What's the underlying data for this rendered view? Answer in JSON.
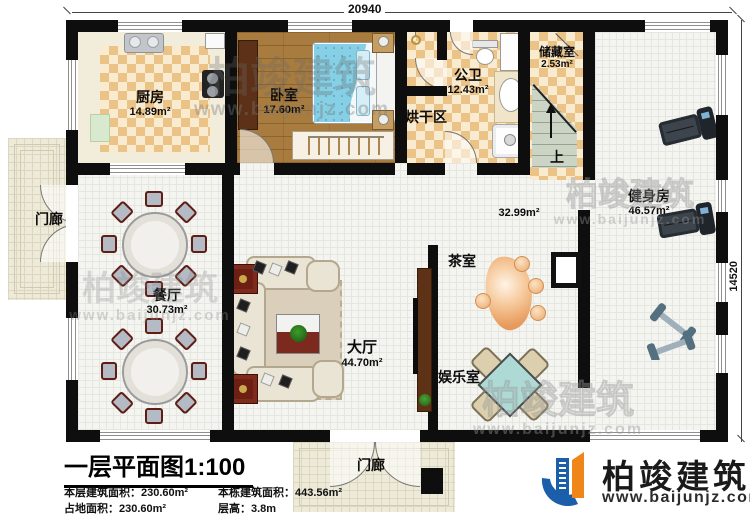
{
  "plan": {
    "dimension_top": "20940",
    "dimension_right": "14520",
    "stairs_up_label": "上"
  },
  "rooms": {
    "kitchen": {
      "name": "厨房",
      "area": "14.89m²"
    },
    "bedroom": {
      "name": "卧室",
      "area": "17.60m²"
    },
    "bathroom": {
      "name": "公卫",
      "area": "12.43m²"
    },
    "drying_area": {
      "name": "烘干区"
    },
    "storage": {
      "name": "储藏室",
      "area": "2.53m²"
    },
    "gym": {
      "name": "健身房",
      "area": "46.57m²"
    },
    "hallway": {
      "area": "32.99m²"
    },
    "tea_room": {
      "name": "茶室"
    },
    "game_room": {
      "name": "娱乐室"
    },
    "dining": {
      "name": "餐厅",
      "area": "30.73m²"
    },
    "hall": {
      "name": "大厅",
      "area": "44.70m²"
    },
    "porch_left": {
      "name": "门廊"
    },
    "porch_bottom": {
      "name": "门廊"
    }
  },
  "title_block": {
    "title": "一层平面图1:100",
    "stats": [
      {
        "label": "本层建筑面积：",
        "value": "230.60m²"
      },
      {
        "label": "本栋建筑面积：",
        "value": "443.56m²"
      },
      {
        "label": "占地面积：",
        "value": "230.60m²"
      },
      {
        "label": "层高：",
        "value": "3.8m"
      }
    ]
  },
  "logo": {
    "brand": "柏竣建筑",
    "url": "www.baijunjz.com"
  },
  "watermark": {
    "brand": "柏竣建筑",
    "url": "www.baijunjz.com"
  },
  "colors": {
    "wall": "#0e0e0e",
    "checker_tile": "#ecc387",
    "wood_floor": "#a87c3e",
    "bed_blue": "#86cfe4",
    "brand_blue": "#1b5ea9",
    "brand_orange": "#f08519",
    "mahjong_teal": "#aedad6"
  }
}
